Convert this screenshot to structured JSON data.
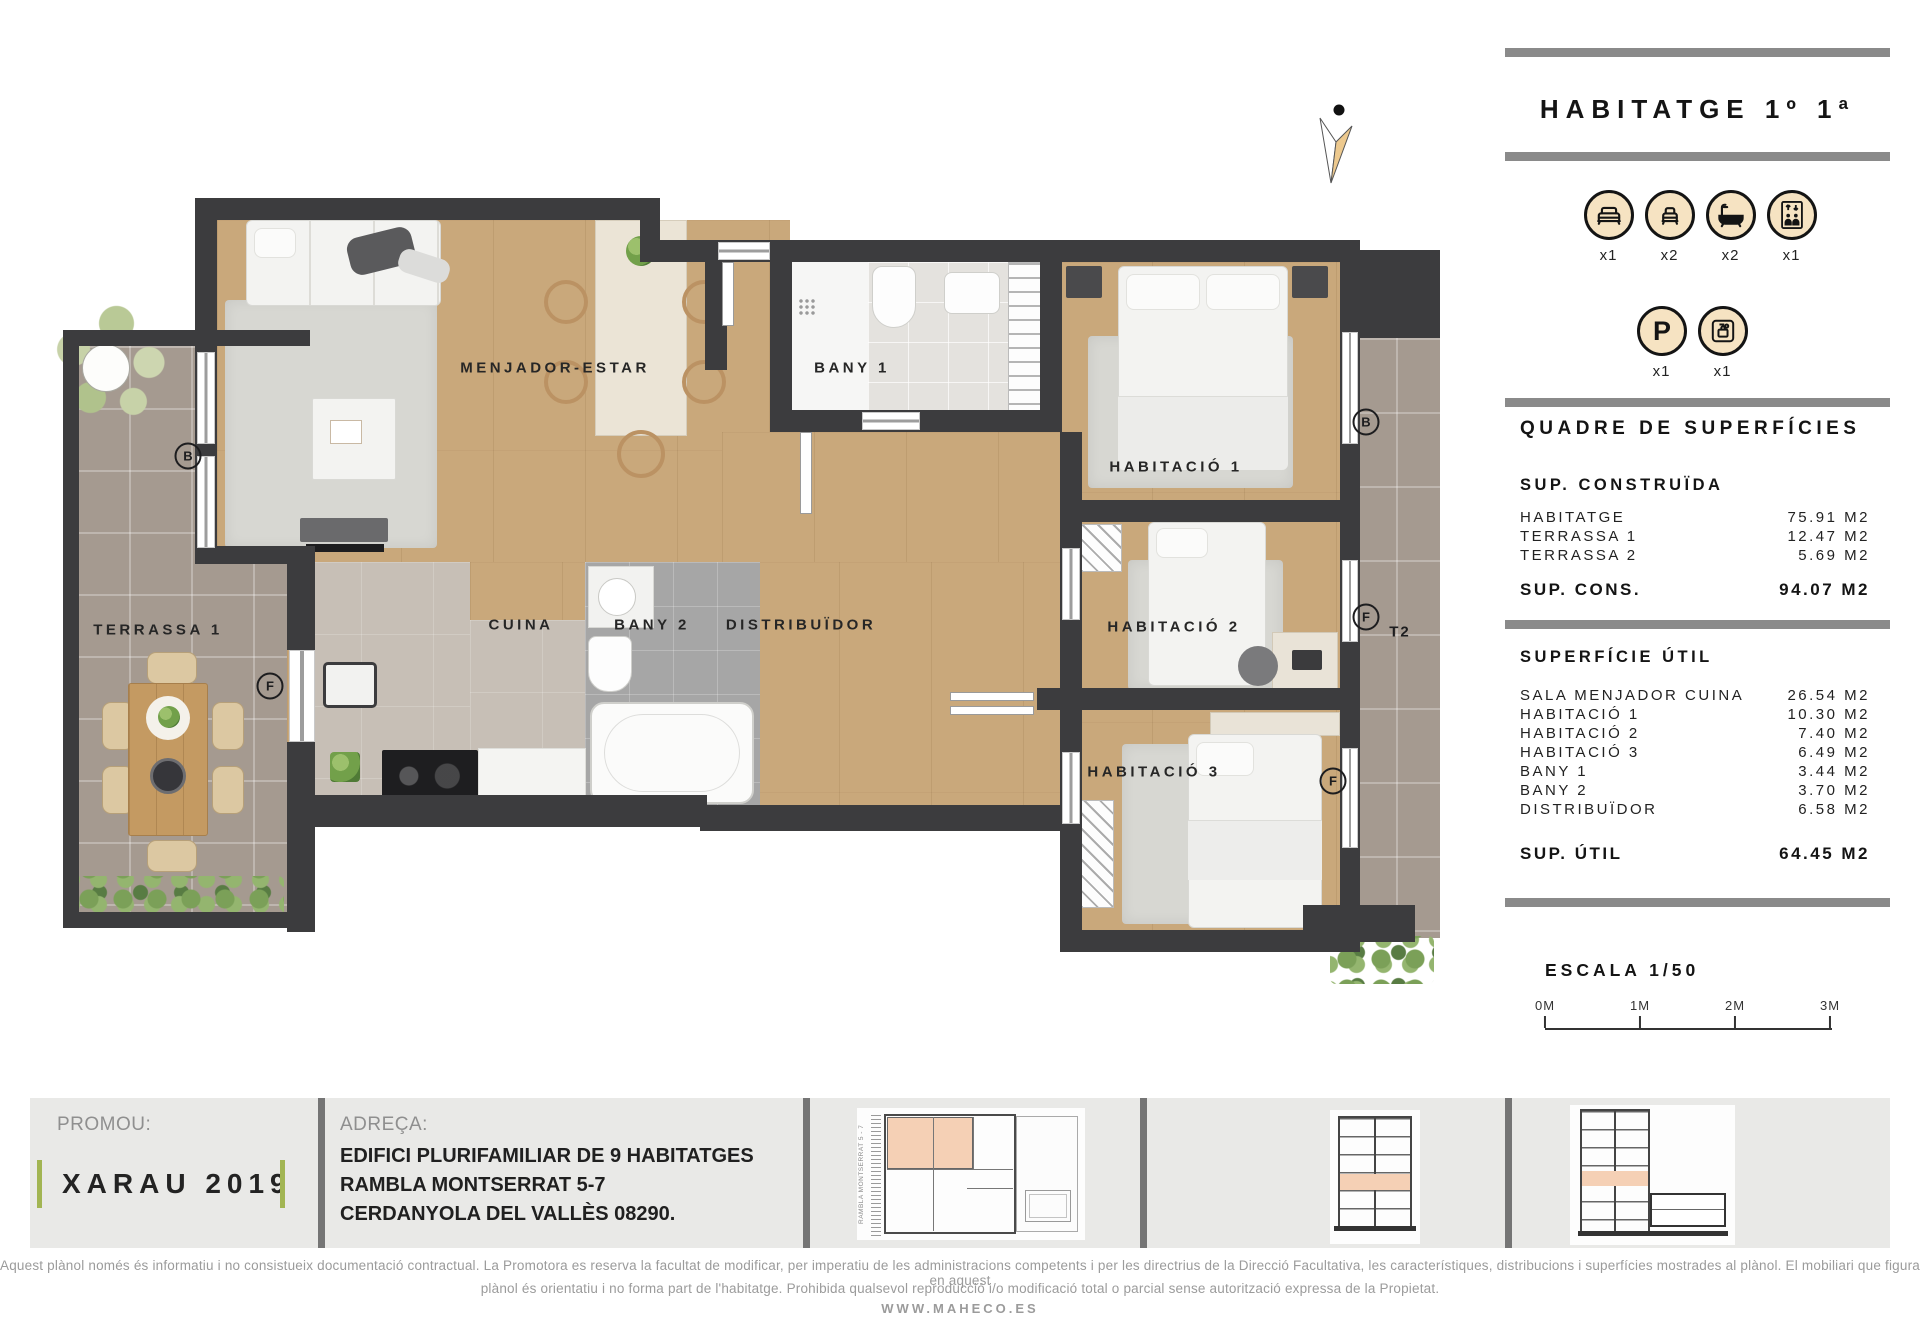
{
  "panel": {
    "title": "HABITATGE 1º 1ª",
    "amenities_row1": [
      {
        "icon": "double-bed-icon",
        "count": "x1"
      },
      {
        "icon": "single-bed-icon",
        "count": "x2"
      },
      {
        "icon": "bathtub-icon",
        "count": "x2"
      },
      {
        "icon": "elevator-icon",
        "count": "x1"
      }
    ],
    "amenities_row2": [
      {
        "icon": "parking-icon",
        "count": "x1"
      },
      {
        "icon": "storage-icon",
        "count": "x1"
      }
    ],
    "surfaces_heading": "QUADRE DE SUPERFÍCIES",
    "built": {
      "heading": "SUP. CONSTRUÏDA",
      "rows": [
        {
          "label": "HABITATGE",
          "value": "75.91 M2"
        },
        {
          "label": "TERRASSA 1",
          "value": "12.47 M2"
        },
        {
          "label": "TERRASSA 2",
          "value": "5.69 M2"
        }
      ],
      "total_label": "SUP. CONS.",
      "total_value": "94.07 M2"
    },
    "useful": {
      "heading": "SUPERFÍCIE ÚTIL",
      "rows": [
        {
          "label": "SALA MENJADOR CUINA",
          "value": "26.54 M2"
        },
        {
          "label": "HABITACIÓ 1",
          "value": "10.30 M2"
        },
        {
          "label": "HABITACIÓ 2",
          "value": "7.40 M2"
        },
        {
          "label": "HABITACIÓ 3",
          "value": "6.49 M2"
        },
        {
          "label": "BANY 1",
          "value": "3.44 M2"
        },
        {
          "label": "BANY 2",
          "value": "3.70 M2"
        },
        {
          "label": "DISTRIBUÏDOR",
          "value": "6.58 M2"
        }
      ],
      "total_label": "SUP. ÚTIL",
      "total_value": "64.45 M2"
    },
    "scale_label": "ESCALA 1/50",
    "scale_ticks": [
      {
        "label": "0M",
        "x": 1545
      },
      {
        "label": "1M",
        "x": 1640
      },
      {
        "label": "2M",
        "x": 1735
      },
      {
        "label": "3M",
        "x": 1830
      }
    ]
  },
  "plan": {
    "room_labels": [
      {
        "text": "MENJADOR-ESTAR",
        "x": 555,
        "y": 368
      },
      {
        "text": "BANY 1",
        "x": 852,
        "y": 368
      },
      {
        "text": "HABITACIÓ 1",
        "x": 1176,
        "y": 467
      },
      {
        "text": "TERRASSA 1",
        "x": 158,
        "y": 630
      },
      {
        "text": "CUINA",
        "x": 521,
        "y": 625
      },
      {
        "text": "BANY 2",
        "x": 652,
        "y": 625
      },
      {
        "text": "DISTRIBUÏDOR",
        "x": 801,
        "y": 625
      },
      {
        "text": "HABITACIÓ 2",
        "x": 1174,
        "y": 627
      },
      {
        "text": "HABITACIÓ 3",
        "x": 1154,
        "y": 772
      }
    ],
    "markers": [
      {
        "text": "B",
        "x": 188,
        "y": 456
      },
      {
        "text": "F",
        "x": 270,
        "y": 686
      },
      {
        "text": "B",
        "x": 1366,
        "y": 422
      },
      {
        "text": "F",
        "x": 1366,
        "y": 617
      },
      {
        "text": "F",
        "x": 1333,
        "y": 781
      },
      {
        "text": "T2",
        "x": 1400,
        "y": 632,
        "circled": false
      }
    ]
  },
  "footer": {
    "promoter_label": "PROMOU:",
    "promoter_name": "XARAU 2019",
    "address_label": "ADREÇA:",
    "address_lines": [
      "EDIFICI PLURIFAMILIAR DE 9 HABITATGES",
      "RAMBLA MONTSERRAT 5-7",
      "CERDANYOLA DEL VALLÈS 08290."
    ],
    "siteplan_street": "RAMBLA MONTSERRAT 5 - 7"
  },
  "legal": {
    "line1": "Aquest plànol només és informatiu i no consistueix documentació contractual. La Promotora es reserva la facultat de modificar, per imperatiu de les administracions competents i per les directrius de la Direcció Facultativa, les característiques, distribucions i superfícies mostrades al plànol. El mobiliari que figura en aquest",
    "line2": "plànol és orientatiu i no forma part de l'habitatge. Prohibida qualsevol reproducció i/o modificació total o parcial sense autorització expressa de la Propietat.",
    "website": "WWW.MAHECO.ES"
  },
  "colors": {
    "accent_green": "#a2b553",
    "icon_fill": "#f6e3c2",
    "highlight_peach": "#f5d0b5",
    "wall_dark": "#3c3c3e",
    "wood_floor": "#c9a87b"
  }
}
